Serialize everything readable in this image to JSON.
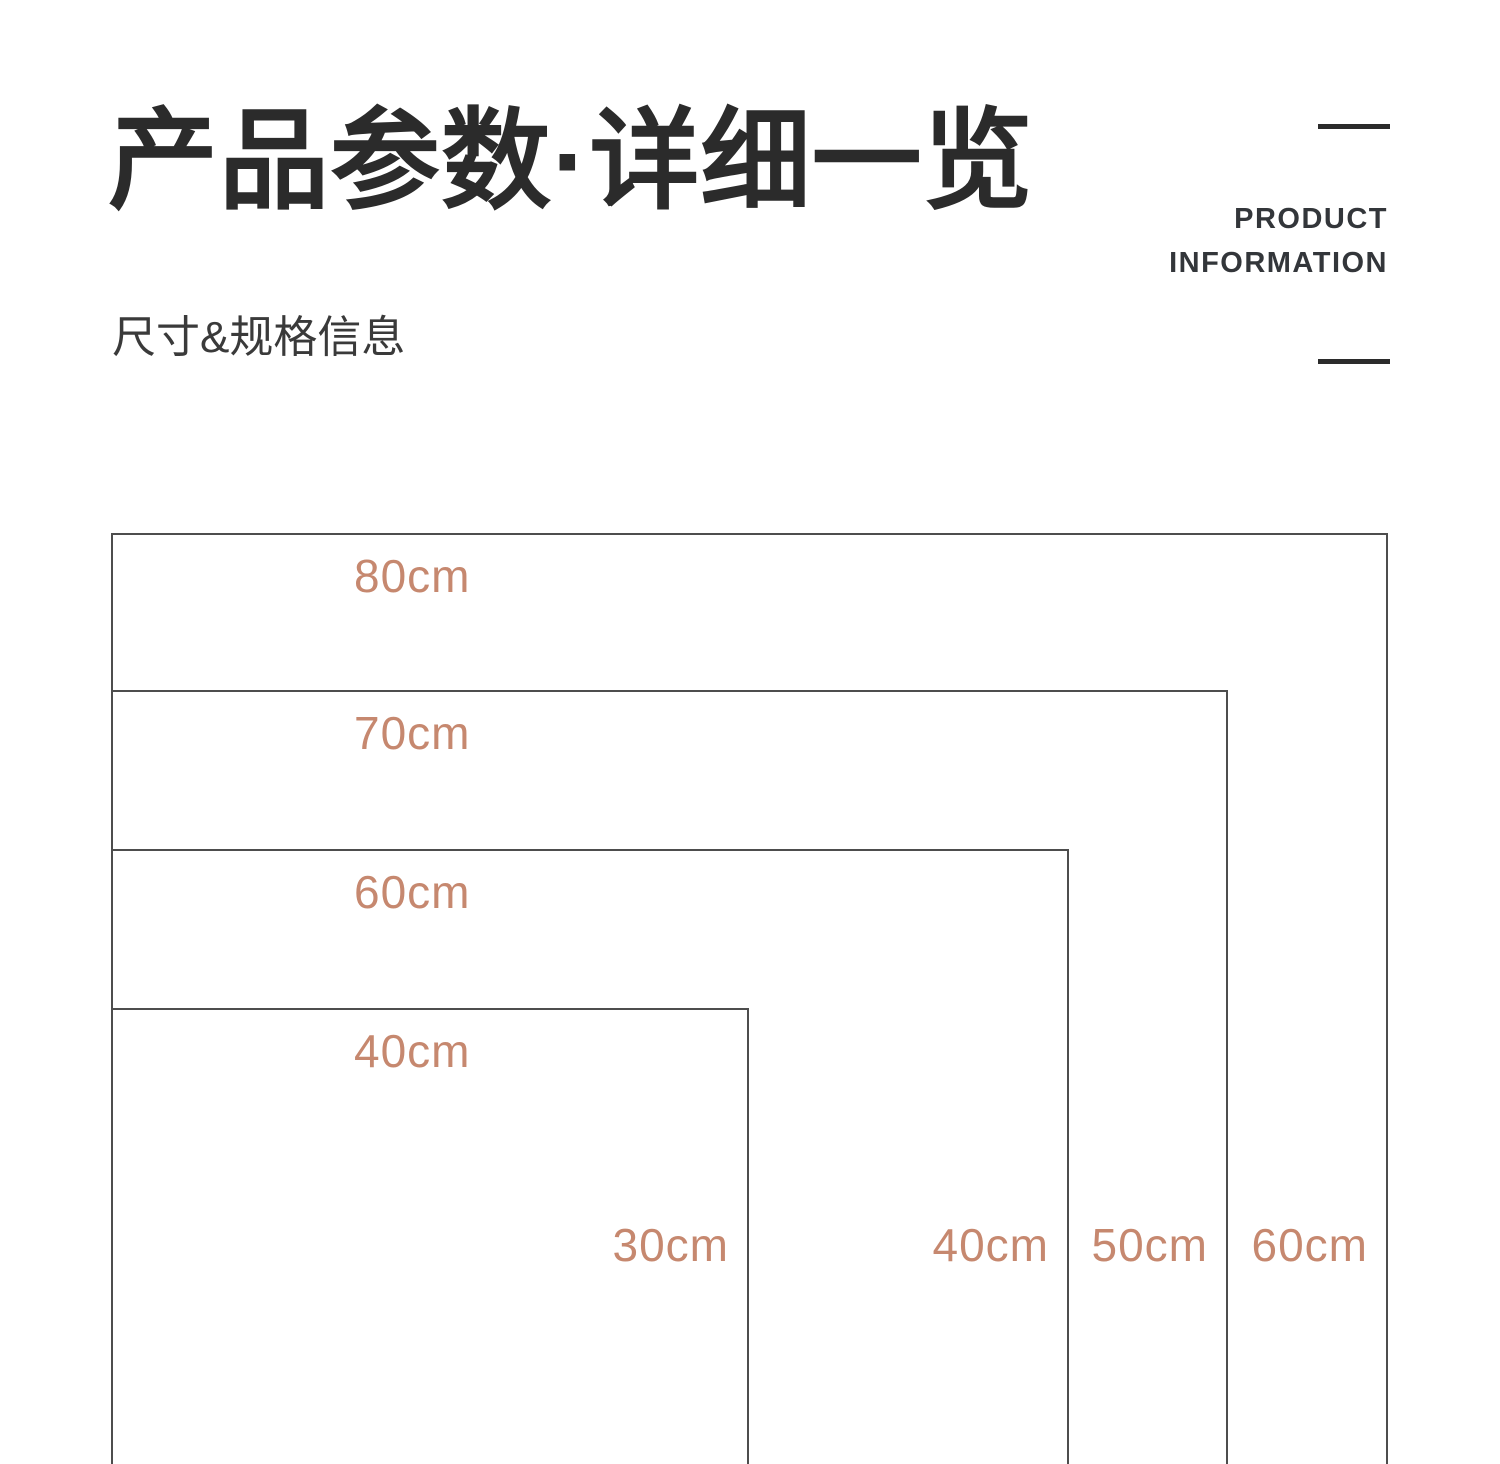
{
  "header": {
    "title": "产品参数·详细一览",
    "subtitle": "尺寸&规格信息",
    "eyebrow_line1": "PRODUCT",
    "eyebrow_line2": "INFORMATION"
  },
  "colors": {
    "title": "#2b2b2b",
    "dimension_label": "#c6886f",
    "rect_line": "#4d4d4d"
  },
  "chart_data": {
    "type": "diagram-nested-rectangles",
    "unit": "cm",
    "note": "nested size outlines sharing top-left corner, bottoms cropped by page edge",
    "sizes": [
      {
        "width_cm": 80,
        "depth_cm": 60,
        "width_label": "80cm",
        "depth_label": "60cm"
      },
      {
        "width_cm": 70,
        "depth_cm": 50,
        "width_label": "70cm",
        "depth_label": "50cm"
      },
      {
        "width_cm": 60,
        "depth_cm": 40,
        "width_label": "60cm",
        "depth_label": "40cm"
      },
      {
        "width_cm": 40,
        "depth_cm": 30,
        "width_label": "40cm",
        "depth_label": "30cm"
      }
    ]
  }
}
